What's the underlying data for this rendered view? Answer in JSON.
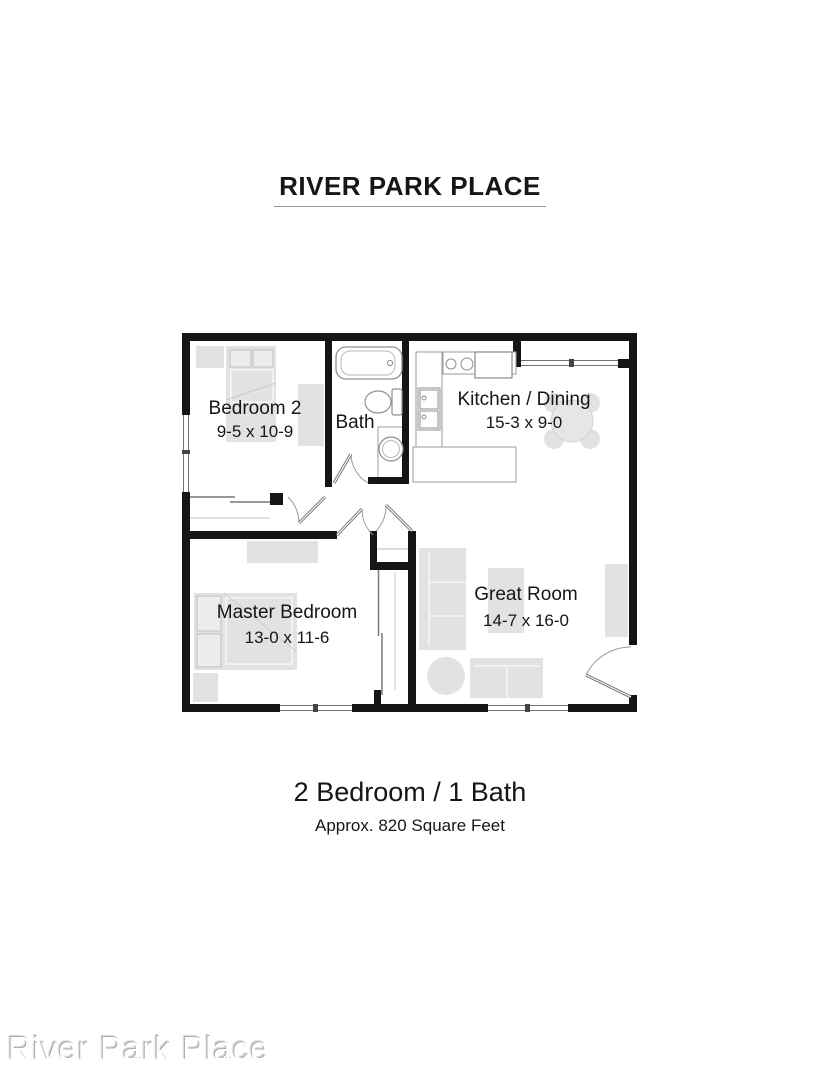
{
  "page": {
    "title": "RIVER PARK PLACE",
    "summary_line1": "2 Bedroom / 1 Bath",
    "summary_line2": "Approx. 820 Square Feet",
    "watermark": "River Park Place"
  },
  "floorplan": {
    "rooms": [
      {
        "name": "Bedroom 2",
        "dims": "9-5 x 10-9"
      },
      {
        "name": "Bath",
        "dims": ""
      },
      {
        "name": "Kitchen / Dining",
        "dims": "15-3 x 9-0"
      },
      {
        "name": "Master Bedroom",
        "dims": "13-0 x 11-6"
      },
      {
        "name": "Great Room",
        "dims": "14-7 x 16-0"
      }
    ],
    "colors": {
      "wall": "#151515",
      "furniture": "#e2e2e2",
      "fixture_outline": "#8f8f8f",
      "window_line": "#707070",
      "label_text": "#161616"
    }
  }
}
